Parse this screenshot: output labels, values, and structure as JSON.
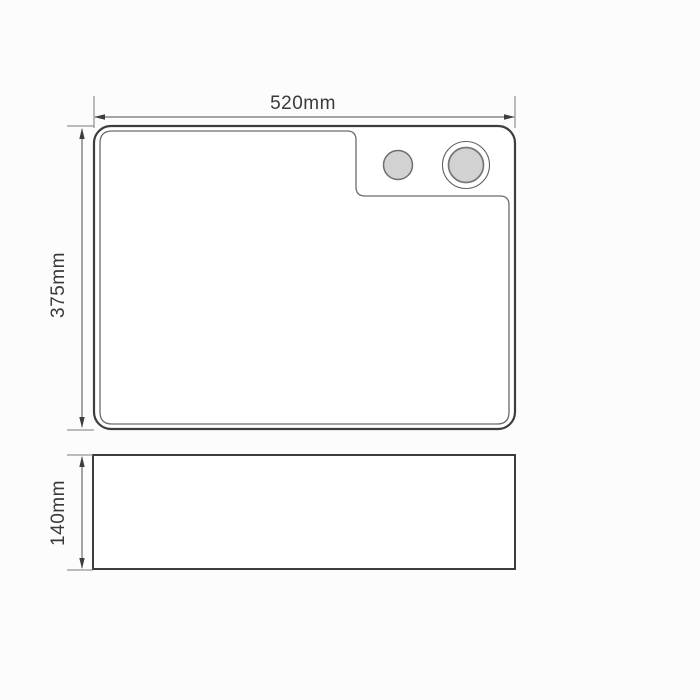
{
  "drawing": {
    "dimension_labels": {
      "width": "520mm",
      "height": "375mm",
      "depth": "140mm"
    },
    "colors": {
      "outline": "#3d3d3d",
      "thin_line": "#6b6b6b",
      "dimension_line": "#4d4d4d",
      "hole_fill": "#d2d2d2",
      "background": "#fcfcfc"
    }
  }
}
